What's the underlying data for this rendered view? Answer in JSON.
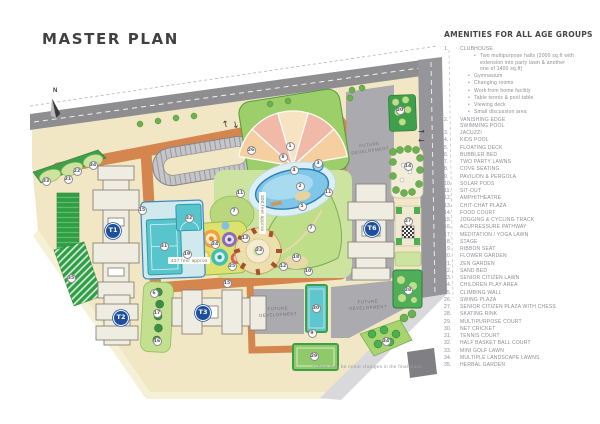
{
  "title": "MASTER PLAN",
  "north_label": "N",
  "footnote": "*There may be minor changes in the final plans",
  "amenities": {
    "heading": "AMENITIES FOR ALL AGE GROUPS",
    "items": [
      {
        "n": "1",
        "label": "CLUBHOUSE",
        "bullets": [
          "Two multipurpose halls (2000 sq.ft with extension into party lawn & another one of 1400 sq.ft)",
          "Gymnasium",
          "Changing rooms",
          "Work from home facility",
          "Table tennis & pool table",
          "Viewing deck",
          "Small discussion area"
        ]
      },
      {
        "n": "2",
        "label": "VANISHING EDGE\nSWIMMING POOL"
      },
      {
        "n": "3",
        "label": "JACUZZI"
      },
      {
        "n": "4",
        "label": "KIDS POOL"
      },
      {
        "n": "5",
        "label": "FLOATING DECK"
      },
      {
        "n": "6",
        "label": "BUBBLER BED"
      },
      {
        "n": "7",
        "label": "TWO PARTY LAWNS"
      },
      {
        "n": "8",
        "label": "COVE SEATING"
      },
      {
        "n": "9",
        "label": "PAVILION & PERGOLA"
      },
      {
        "n": "10",
        "label": "SOLAR PODS"
      },
      {
        "n": "11",
        "label": "SIT-OUT"
      },
      {
        "n": "12",
        "label": "AMPHITHEATRE"
      },
      {
        "n": "13",
        "label": "CHIT-CHAT PLAZA"
      },
      {
        "n": "14",
        "label": "FOOD COURT"
      },
      {
        "n": "15",
        "label": "JOGGING & CYCLING TRACK"
      },
      {
        "n": "16",
        "label": "ACUPRESSURE PATHWAY"
      },
      {
        "n": "17",
        "label": "MEDITATION / YOGA LAWN"
      },
      {
        "n": "18",
        "label": "STAGE"
      },
      {
        "n": "19",
        "label": "RIBBON SEAT"
      },
      {
        "n": "20",
        "label": "FLOWER GARDEN"
      },
      {
        "n": "21",
        "label": "ZEN GARDEN"
      },
      {
        "n": "22",
        "label": "SAND BED"
      },
      {
        "n": "23",
        "label": "SENIOR CITIZEN LAWN"
      },
      {
        "n": "24",
        "label": "CHILDREN PLAY AREA"
      },
      {
        "n": "25",
        "label": "CLIMBING WALL"
      },
      {
        "n": "26",
        "label": "SWING PLAZA"
      },
      {
        "n": "27",
        "label": "SENIOR CITIZEN PLAZA WITH CHESS"
      },
      {
        "n": "28",
        "label": "SKATING RINK"
      },
      {
        "n": "29",
        "label": "MULTIPURPOSE COURT"
      },
      {
        "n": "30",
        "label": "NET CRICKET"
      },
      {
        "n": "31",
        "label": "TENNIS COURT"
      },
      {
        "n": "32",
        "label": "HALF BASKET BALL COURT"
      },
      {
        "n": "33",
        "label": "MINI GOLF LAWN"
      },
      {
        "n": "34",
        "label": "MULTIPLE LANDSCAPE LAWNS"
      },
      {
        "n": "35",
        "label": "HERBAL GARDEN"
      }
    ]
  },
  "plan": {
    "future_label": "FUTURE DEVELOPMENT",
    "dim_horizontal": "427 feet approx",
    "dim_vertical": "300 feet approx",
    "towers": [
      {
        "label": "T1",
        "x": 113,
        "y": 231
      },
      {
        "label": "T2",
        "x": 121,
        "y": 318
      },
      {
        "label": "T3",
        "x": 203,
        "y": 313
      },
      {
        "label": "T6",
        "x": 372,
        "y": 229
      }
    ],
    "markers": [
      {
        "n": "1",
        "x": 290,
        "y": 146
      },
      {
        "n": "2",
        "x": 300,
        "y": 186
      },
      {
        "n": "3",
        "x": 318,
        "y": 163
      },
      {
        "n": "4",
        "x": 294,
        "y": 170
      },
      {
        "n": "5",
        "x": 302,
        "y": 206
      },
      {
        "n": "6",
        "x": 154,
        "y": 293
      },
      {
        "n": "7",
        "x": 234,
        "y": 211
      },
      {
        "n": "7",
        "x": 311,
        "y": 228
      },
      {
        "n": "8",
        "x": 283,
        "y": 157
      },
      {
        "n": "9",
        "x": 312,
        "y": 333
      },
      {
        "n": "10",
        "x": 308,
        "y": 271
      },
      {
        "n": "11",
        "x": 240,
        "y": 193
      },
      {
        "n": "11",
        "x": 328,
        "y": 192
      },
      {
        "n": "12",
        "x": 283,
        "y": 266
      },
      {
        "n": "13",
        "x": 245,
        "y": 238
      },
      {
        "n": "14",
        "x": 408,
        "y": 166
      },
      {
        "n": "15",
        "x": 142,
        "y": 210
      },
      {
        "n": "15",
        "x": 227,
        "y": 283
      },
      {
        "n": "16",
        "x": 157,
        "y": 341
      },
      {
        "n": "17",
        "x": 157,
        "y": 313
      },
      {
        "n": "18",
        "x": 296,
        "y": 257
      },
      {
        "n": "19",
        "x": 187,
        "y": 254
      },
      {
        "n": "20",
        "x": 400,
        "y": 110
      },
      {
        "n": "21",
        "x": 68,
        "y": 179
      },
      {
        "n": "22",
        "x": 77,
        "y": 171
      },
      {
        "n": "23",
        "x": 259,
        "y": 250
      },
      {
        "n": "24",
        "x": 215,
        "y": 244
      },
      {
        "n": "25",
        "x": 232,
        "y": 266
      },
      {
        "n": "26",
        "x": 251,
        "y": 150
      },
      {
        "n": "27",
        "x": 408,
        "y": 221
      },
      {
        "n": "28",
        "x": 408,
        "y": 290
      },
      {
        "n": "29",
        "x": 314,
        "y": 356
      },
      {
        "n": "30",
        "x": 316,
        "y": 308
      },
      {
        "n": "31",
        "x": 164,
        "y": 246
      },
      {
        "n": "32",
        "x": 189,
        "y": 218
      },
      {
        "n": "33",
        "x": 46,
        "y": 181
      },
      {
        "n": "34",
        "x": 93,
        "y": 165
      },
      {
        "n": "34",
        "x": 386,
        "y": 341
      },
      {
        "n": "35",
        "x": 71,
        "y": 278
      }
    ],
    "colors": {
      "ground": "#f2e7c4",
      "road_orange": "#d5854e",
      "road_gray": "#8e8e91",
      "future_gray": "#ababaf",
      "pool_blue": "#7fc6e8",
      "court_teal": "#58c5cd",
      "green": "#3fa04b",
      "lawn": "#c6e097",
      "tower_badge": "#1d4f9e",
      "clubhouse_pink": "#f1b9a8"
    }
  }
}
